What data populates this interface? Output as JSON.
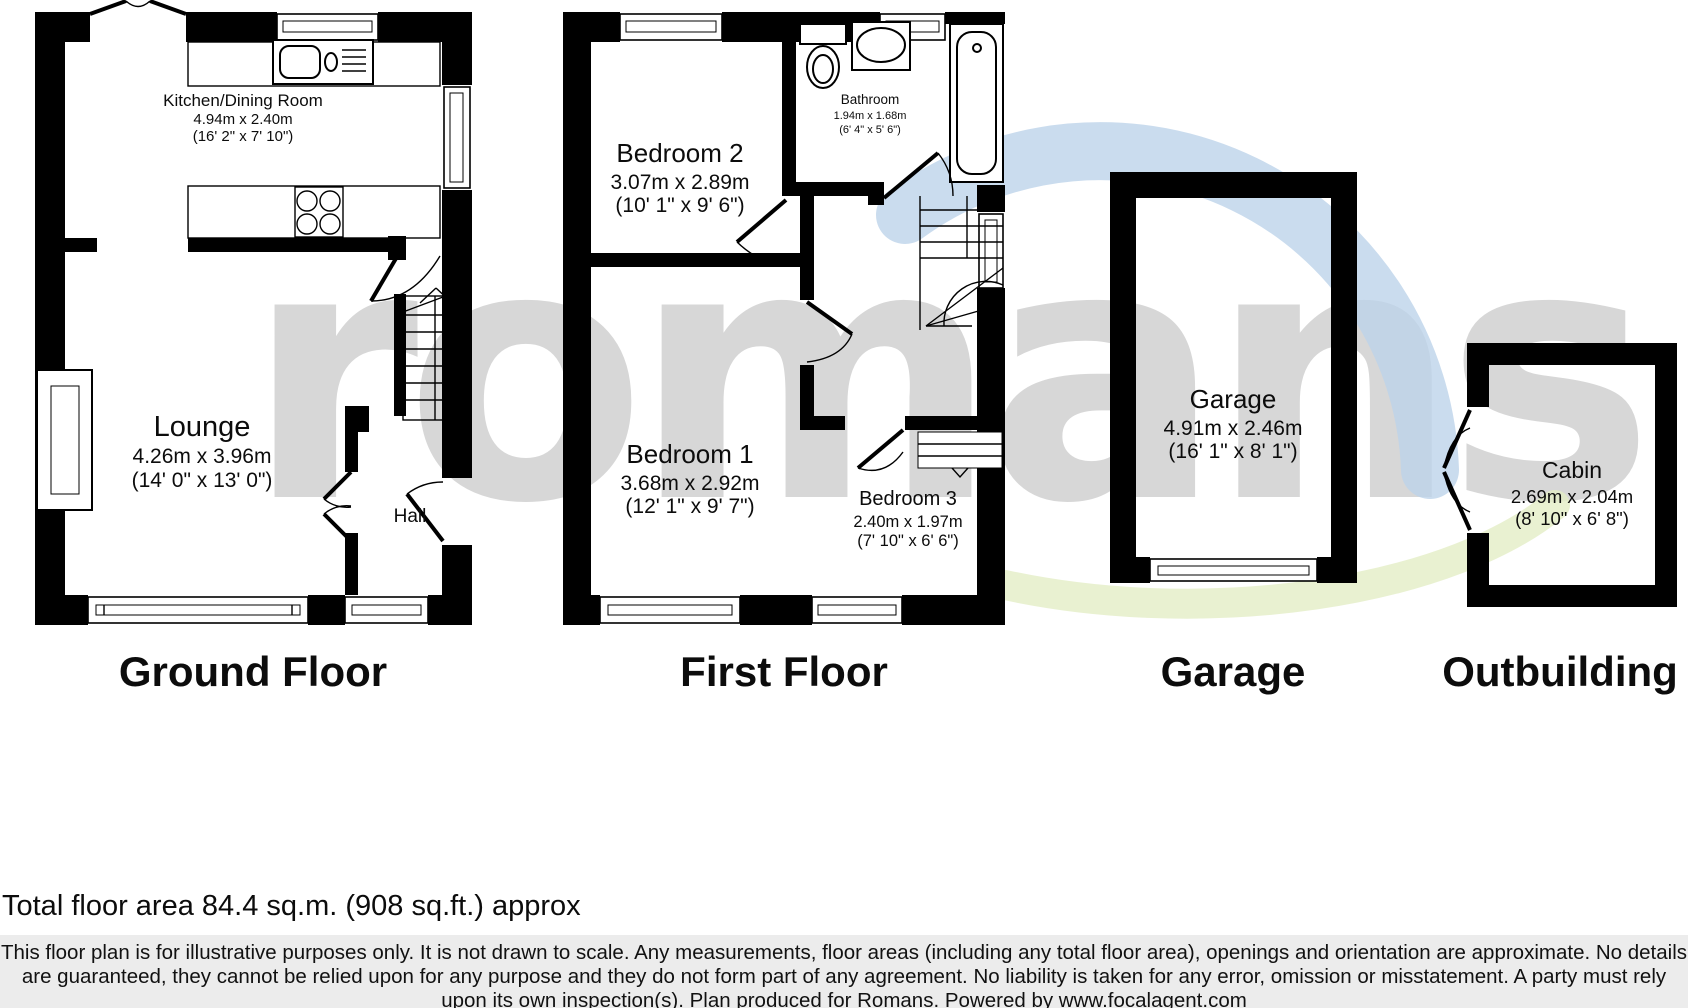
{
  "watermark": {
    "text": "romans",
    "gray": "#d7d7d7",
    "blue": "#bdd3ea",
    "green": "#e4edc6"
  },
  "floors": {
    "ground": {
      "label": "Ground Floor",
      "rooms": {
        "kitchen": {
          "name": "Kitchen/Dining Room",
          "metric": "4.94m x 2.40m",
          "imperial": "(16' 2\" x 7' 10\")"
        },
        "lounge": {
          "name": "Lounge",
          "metric": "4.26m x 3.96m",
          "imperial": "(14' 0\" x 13' 0\")"
        },
        "hall": {
          "name": "Hall"
        }
      }
    },
    "first": {
      "label": "First Floor",
      "rooms": {
        "bedroom2": {
          "name": "Bedroom 2",
          "metric": "3.07m x 2.89m",
          "imperial": "(10' 1\" x 9' 6\")"
        },
        "bathroom": {
          "name": "Bathroom",
          "metric": "1.94m x 1.68m",
          "imperial": "(6' 4\" x 5' 6\")"
        },
        "bedroom1": {
          "name": "Bedroom 1",
          "metric": "3.68m x 2.92m",
          "imperial": "(12' 1\" x 9' 7\")"
        },
        "bedroom3": {
          "name": "Bedroom 3",
          "metric": "2.40m x 1.97m",
          "imperial": "(7' 10\" x 6' 6\")"
        }
      }
    },
    "garage": {
      "label": "Garage",
      "rooms": {
        "garage": {
          "name": "Garage",
          "metric": "4.91m x 2.46m",
          "imperial": "(16' 1\" x 8' 1\")"
        }
      }
    },
    "outbuilding": {
      "label": "Outbuilding",
      "rooms": {
        "cabin": {
          "name": "Cabin",
          "metric": "2.69m x 2.04m",
          "imperial": "(8' 10\" x 6' 8\")"
        }
      }
    }
  },
  "footer": {
    "total_area": "Total floor area 84.4 sq.m. (908 sq.ft.) approx",
    "disclaimer": "This floor plan is for illustrative purposes only. It is not drawn to scale. Any measurements, floor areas (including any total floor area), openings and orientation are approximate. No details are guaranteed, they cannot be relied upon for any purpose and they do not form part of any agreement. No liability is taken for any error, omission or misstatement. A party must rely upon its own inspection(s). Plan produced for Romans. Powered by www.focalagent.com"
  }
}
